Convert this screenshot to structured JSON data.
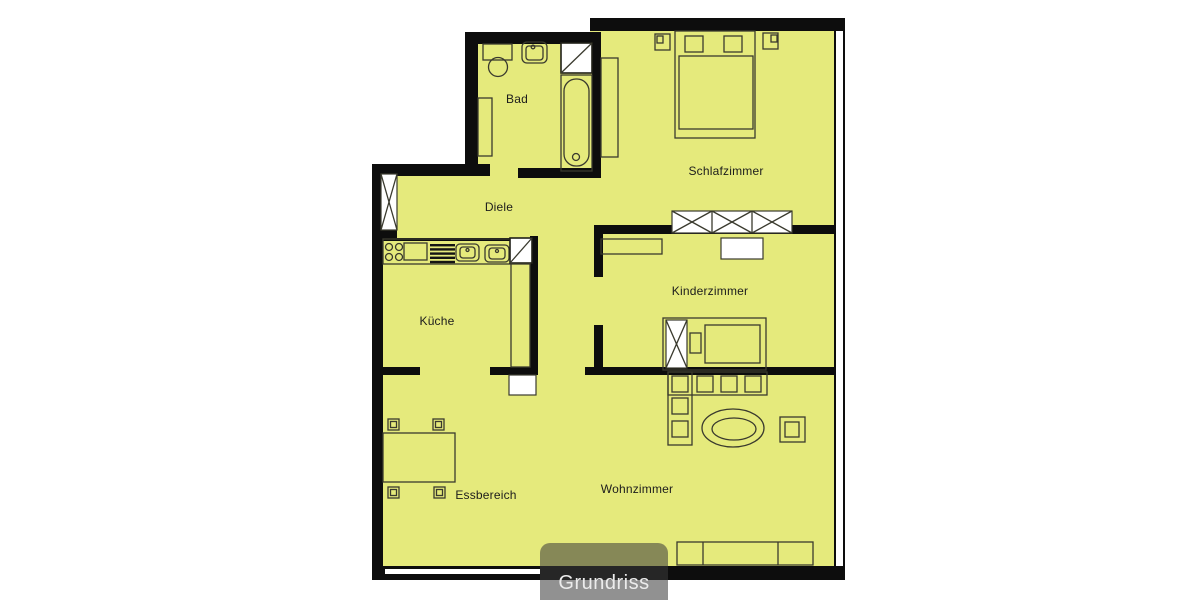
{
  "page": {
    "background": "#ffffff"
  },
  "plan": {
    "floor_color": "#e5ea7c",
    "wall_color": "#0d0d0d",
    "line_color": "#3a3a2e",
    "fixture_fill": "#ffffff",
    "rooms": {
      "bad": {
        "label": "Bad"
      },
      "diele": {
        "label": "Diele"
      },
      "kueche": {
        "label": "Küche"
      },
      "schlafzimmer": {
        "label": "Schlafzimmer"
      },
      "kinderzimmer": {
        "label": "Kinderzimmer"
      },
      "essbereich": {
        "label": "Essbereich"
      },
      "wohnzimmer": {
        "label": "Wohnzimmer"
      }
    },
    "overlay": {
      "label": "Grundriss",
      "box_color": "rgba(58,58,58,0.56)",
      "text_color": "#ececec"
    }
  }
}
